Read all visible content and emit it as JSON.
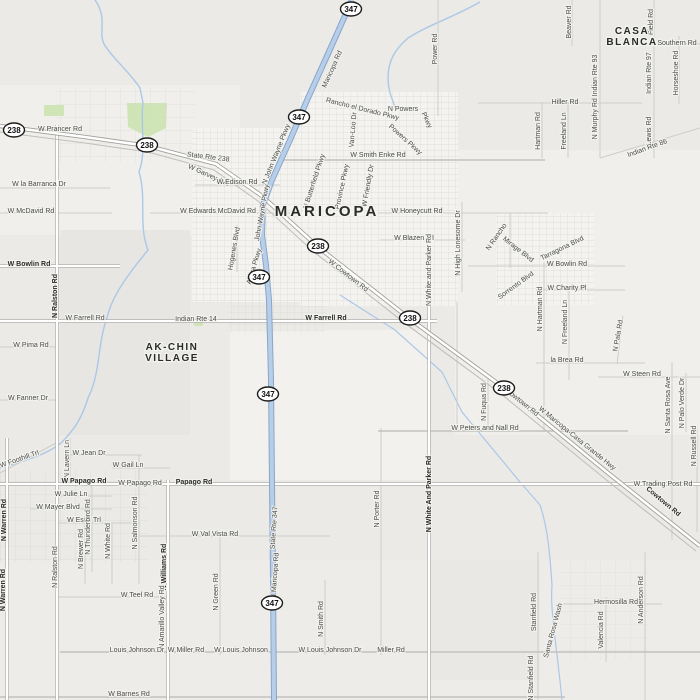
{
  "map": {
    "base_color": "#ebeae6",
    "road_color": "#ffffff",
    "highway_color": "#b7cee9",
    "highway_casing": "#89a6c9",
    "water_color": "#abc8e7",
    "park_color": "#cfe5b6",
    "label_color": "#4a4a47",
    "bold_label_color": "#2a2a28",
    "places": [
      {
        "lines": [
          "MARICOPA"
        ],
        "x": 327,
        "y": 216,
        "size": 15,
        "spacing": 3
      },
      {
        "lines": [
          "AK-CHIN",
          "VILLAGE"
        ],
        "x": 172,
        "y": 350,
        "size": 10,
        "spacing": 1.5
      },
      {
        "lines": [
          "CASA",
          "BLANCA"
        ],
        "x": 632,
        "y": 34,
        "size": 10,
        "spacing": 1.5
      }
    ],
    "shields": [
      {
        "route": "347",
        "x": 351,
        "y": 9
      },
      {
        "route": "238",
        "x": 14,
        "y": 130
      },
      {
        "route": "238",
        "x": 147,
        "y": 145
      },
      {
        "route": "347",
        "x": 299,
        "y": 117
      },
      {
        "route": "238",
        "x": 318,
        "y": 246
      },
      {
        "route": "347",
        "x": 259,
        "y": 277
      },
      {
        "route": "238",
        "x": 410,
        "y": 318
      },
      {
        "route": "238",
        "x": 504,
        "y": 388
      },
      {
        "route": "347",
        "x": 268,
        "y": 394
      },
      {
        "route": "347",
        "x": 272,
        "y": 603
      }
    ],
    "road_labels": [
      {
        "t": "Maricopa Rd",
        "x": 334,
        "y": 70,
        "r": -66
      },
      {
        "t": "Power Rd",
        "x": 437,
        "y": 49,
        "r": -90
      },
      {
        "t": "Rancho el Dorado Pkwy",
        "x": 362,
        "y": 111,
        "r": 14
      },
      {
        "t": "Van-Loo Dr",
        "x": 355,
        "y": 130,
        "r": -85
      },
      {
        "t": "N Powers",
        "x": 403,
        "y": 111
      },
      {
        "t": "Pkwy",
        "x": 425,
        "y": 121,
        "r": 65
      },
      {
        "t": "Powers Pkwy",
        "x": 404,
        "y": 141,
        "r": 42
      },
      {
        "t": "W Smith Enke Rd",
        "x": 378,
        "y": 157
      },
      {
        "t": "Beaver Rd",
        "x": 571,
        "y": 22,
        "r": -90
      },
      {
        "t": "Field Rd",
        "x": 653,
        "y": 22,
        "r": -90
      },
      {
        "t": "Southern Rd",
        "x": 677,
        "y": 45
      },
      {
        "t": "Horseshoe Rd",
        "x": 678,
        "y": 73,
        "r": -90
      },
      {
        "t": "Indian Rte 97",
        "x": 651,
        "y": 73,
        "r": -90
      },
      {
        "t": "N Murphy Rd Indian Rte 93",
        "x": 597,
        "y": 97,
        "r": -90
      },
      {
        "t": "Hiller Rd",
        "x": 565,
        "y": 104
      },
      {
        "t": "Hartman Rd",
        "x": 540,
        "y": 131,
        "r": -90
      },
      {
        "t": "Freeland Ln",
        "x": 566,
        "y": 131,
        "r": -90
      },
      {
        "t": "Lewis Rd",
        "x": 651,
        "y": 131,
        "r": -90
      },
      {
        "t": "Indian Rte 86",
        "x": 648,
        "y": 150,
        "r": -20
      },
      {
        "t": "W Prancer Rd",
        "x": 60,
        "y": 131
      },
      {
        "t": "State Rte 238",
        "x": 208,
        "y": 159,
        "r": 7
      },
      {
        "t": "W Garvey Ave",
        "x": 208,
        "y": 177,
        "r": 24
      },
      {
        "t": "W la Barranca Dr",
        "x": 39,
        "y": 186
      },
      {
        "t": "W McDavid Rd",
        "x": 31,
        "y": 213
      },
      {
        "t": "W Edwards McDavid Rd",
        "x": 218,
        "y": 213
      },
      {
        "t": "W Edison Rd",
        "x": 237,
        "y": 184
      },
      {
        "t": "N John Wayne Pkwy",
        "x": 278,
        "y": 155,
        "r": -68
      },
      {
        "t": "John Wayne Pkwy",
        "x": 264,
        "y": 213,
        "r": -80
      },
      {
        "t": "N Butterfield Pkwy",
        "x": 316,
        "y": 182,
        "r": -72
      },
      {
        "t": "Province Pkwy",
        "x": 344,
        "y": 187,
        "r": -78
      },
      {
        "t": "W Friendly Dr",
        "x": 370,
        "y": 186,
        "r": -80
      },
      {
        "t": "W Honeycutt Rd",
        "x": 417,
        "y": 213
      },
      {
        "t": "W Blazen Trl",
        "x": 414,
        "y": 240
      },
      {
        "t": "Hogenes Blvd",
        "x": 236,
        "y": 249,
        "r": -80
      },
      {
        "t": "Altera Pkwy",
        "x": 256,
        "y": 267,
        "r": -73
      },
      {
        "t": "W Cowtown Rd",
        "x": 347,
        "y": 277,
        "r": 38
      },
      {
        "t": "N High Lonesome Dr",
        "x": 460,
        "y": 243,
        "r": -90
      },
      {
        "t": "N Rancho",
        "x": 498,
        "y": 238,
        "r": -55
      },
      {
        "t": "Mirage Blvd",
        "x": 517,
        "y": 251,
        "r": 38
      },
      {
        "t": "Tarragona Blvd",
        "x": 563,
        "y": 250,
        "r": -26
      },
      {
        "t": "W Bowlin Rd",
        "x": 567,
        "y": 266
      },
      {
        "t": "Sorrento Blvd",
        "x": 517,
        "y": 287,
        "r": -36
      },
      {
        "t": "W Charity Pl",
        "x": 567,
        "y": 290
      },
      {
        "t": "N Hartman Rd",
        "x": 542,
        "y": 309,
        "r": -90
      },
      {
        "t": "N Freeland Ln",
        "x": 567,
        "y": 322,
        "r": -90
      },
      {
        "t": "N Pala Rd",
        "x": 620,
        "y": 336,
        "r": -80
      },
      {
        "t": "la Brea Rd",
        "x": 567,
        "y": 362
      },
      {
        "t": "W Steen Rd",
        "x": 642,
        "y": 376
      },
      {
        "t": "N Santa Rosa Ave",
        "x": 670,
        "y": 405,
        "r": -90
      },
      {
        "t": "N Palo Verde Dr",
        "x": 684,
        "y": 403,
        "r": -90
      },
      {
        "t": "N Russell Rd",
        "x": 696,
        "y": 446,
        "r": -90
      },
      {
        "t": "W Bowlin Rd",
        "x": 29,
        "y": 266,
        "b": true
      },
      {
        "t": "N Ralston Rd",
        "x": 57,
        "y": 296,
        "r": -90,
        "b": true
      },
      {
        "t": "W Farrell Rd",
        "x": 85,
        "y": 320
      },
      {
        "t": "Indian Rte 14",
        "x": 196,
        "y": 321
      },
      {
        "t": "W Farrell Rd",
        "x": 326,
        "y": 320,
        "b": true
      },
      {
        "t": "N White and Parker Rd",
        "x": 431,
        "y": 270,
        "r": -90
      },
      {
        "t": "W Pima Rd",
        "x": 31,
        "y": 347
      },
      {
        "t": "W Fanner Dr",
        "x": 28,
        "y": 400
      },
      {
        "t": "Cowtown Rd",
        "x": 521,
        "y": 404,
        "r": 39
      },
      {
        "t": "W Maricopa-Casa Grande Hwy",
        "x": 576,
        "y": 440,
        "r": 39
      },
      {
        "t": "N Fuqua Rd",
        "x": 486,
        "y": 402,
        "r": -90
      },
      {
        "t": "W Peters and Nall Rd",
        "x": 485,
        "y": 430
      },
      {
        "t": "N Porter Rd",
        "x": 379,
        "y": 509,
        "r": -90
      },
      {
        "t": "N White And Parker Rd",
        "x": 431,
        "y": 494,
        "r": -90,
        "b": true
      },
      {
        "t": "W Trading Post Rd",
        "x": 663,
        "y": 486
      },
      {
        "t": "Cowtown Rd",
        "x": 662,
        "y": 503,
        "r": 40,
        "b": true
      },
      {
        "t": "W Foothill Trl",
        "x": 20,
        "y": 461,
        "r": -19
      },
      {
        "t": "N Lavern Ln",
        "x": 69,
        "y": 459,
        "r": -90
      },
      {
        "t": "W Jean Dr",
        "x": 89,
        "y": 455
      },
      {
        "t": "W Gail Ln",
        "x": 128,
        "y": 467
      },
      {
        "t": "W Papago Rd",
        "x": 84,
        "y": 483,
        "b": true
      },
      {
        "t": "W Papago Rd",
        "x": 140,
        "y": 485
      },
      {
        "t": "Papago Rd",
        "x": 194,
        "y": 484,
        "b": true
      },
      {
        "t": "W Julie Ln",
        "x": 71,
        "y": 496
      },
      {
        "t": "W Mayer Blvd",
        "x": 58,
        "y": 509
      },
      {
        "t": "W Esch Trl",
        "x": 84,
        "y": 522
      },
      {
        "t": "N Warren Rd",
        "x": 6,
        "y": 520,
        "r": -90,
        "b": true
      },
      {
        "t": "N Warren Rd",
        "x": 5,
        "y": 590,
        "r": -90,
        "b": true
      },
      {
        "t": "N Thunderbird Rd",
        "x": 90,
        "y": 527,
        "r": -90
      },
      {
        "t": "N Brewer Rd",
        "x": 83,
        "y": 549,
        "r": -90
      },
      {
        "t": "N White Rd",
        "x": 110,
        "y": 541,
        "r": -90
      },
      {
        "t": "N Salmonson Rd",
        "x": 137,
        "y": 523,
        "r": -90
      },
      {
        "t": "N Williams Rd",
        "x": 166,
        "y": 567,
        "r": -90,
        "b": true
      },
      {
        "t": "N Amarillo Valley Rd",
        "x": 164,
        "y": 617,
        "r": -90
      },
      {
        "t": "W Val Vista Rd",
        "x": 215,
        "y": 536
      },
      {
        "t": "N Green Rd",
        "x": 218,
        "y": 592,
        "r": -90
      },
      {
        "t": "State Rte 347",
        "x": 276,
        "y": 528,
        "r": -86
      },
      {
        "t": "N Maricopa Rd",
        "x": 277,
        "y": 576,
        "r": -86
      },
      {
        "t": "N Smith Rd",
        "x": 323,
        "y": 619,
        "r": -90
      },
      {
        "t": "W Teel Rd",
        "x": 137,
        "y": 597
      },
      {
        "t": "Louis Johnson Dr",
        "x": 137,
        "y": 652
      },
      {
        "t": "W Miller Rd",
        "x": 186,
        "y": 652
      },
      {
        "t": "W Louis Johnson",
        "x": 241,
        "y": 652
      },
      {
        "t": "W Louis Johnson Dr",
        "x": 330,
        "y": 652
      },
      {
        "t": "Miller Rd",
        "x": 391,
        "y": 652
      },
      {
        "t": "W Barnes Rd",
        "x": 129,
        "y": 696
      },
      {
        "t": "Stanfield Rd",
        "x": 536,
        "y": 612,
        "r": -90
      },
      {
        "t": "N Stanfield Rd",
        "x": 533,
        "y": 678,
        "r": -90
      },
      {
        "t": "Santa Rosa Wash",
        "x": 555,
        "y": 631,
        "r": -75
      },
      {
        "t": "Hermosilla Rd",
        "x": 616,
        "y": 604
      },
      {
        "t": "Valencia Rd",
        "x": 603,
        "y": 630,
        "r": -90
      },
      {
        "t": "N Anderson Rd",
        "x": 643,
        "y": 600,
        "r": -90
      },
      {
        "t": "N Ralston Rd",
        "x": 57,
        "y": 567,
        "r": -90
      }
    ]
  }
}
